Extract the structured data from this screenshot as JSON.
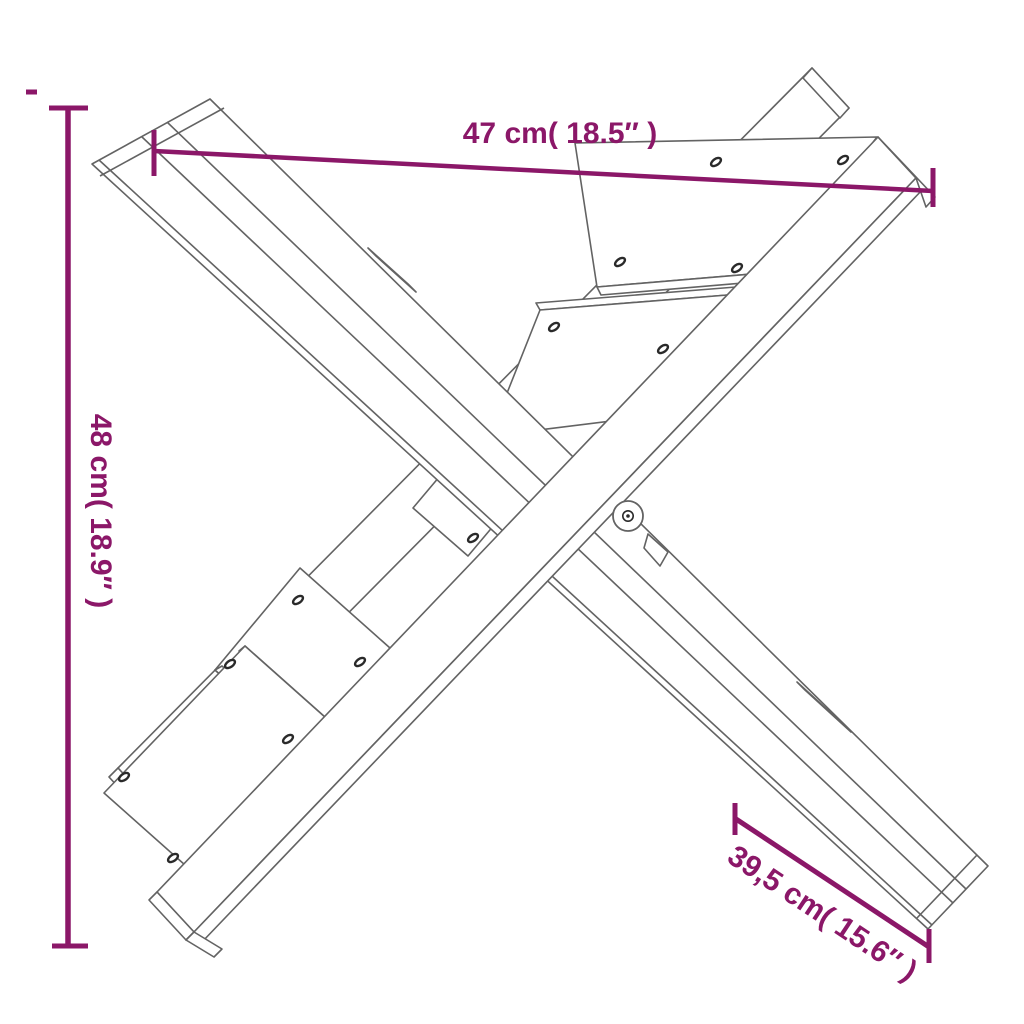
{
  "diagram": {
    "title": "x-shaped-log-holder-dimension-drawing",
    "dimensions": {
      "width": {
        "label": "47 cm( 18.5″ )"
      },
      "height": {
        "label": "48 cm( 18.9″ )"
      },
      "depth": {
        "label": "39,5 cm( 15.6″ )"
      }
    },
    "colors": {
      "dimension": "#8b1768",
      "line_art": "#636363",
      "line_art_dark": "#2a2a2a",
      "background": "#ffffff"
    }
  }
}
